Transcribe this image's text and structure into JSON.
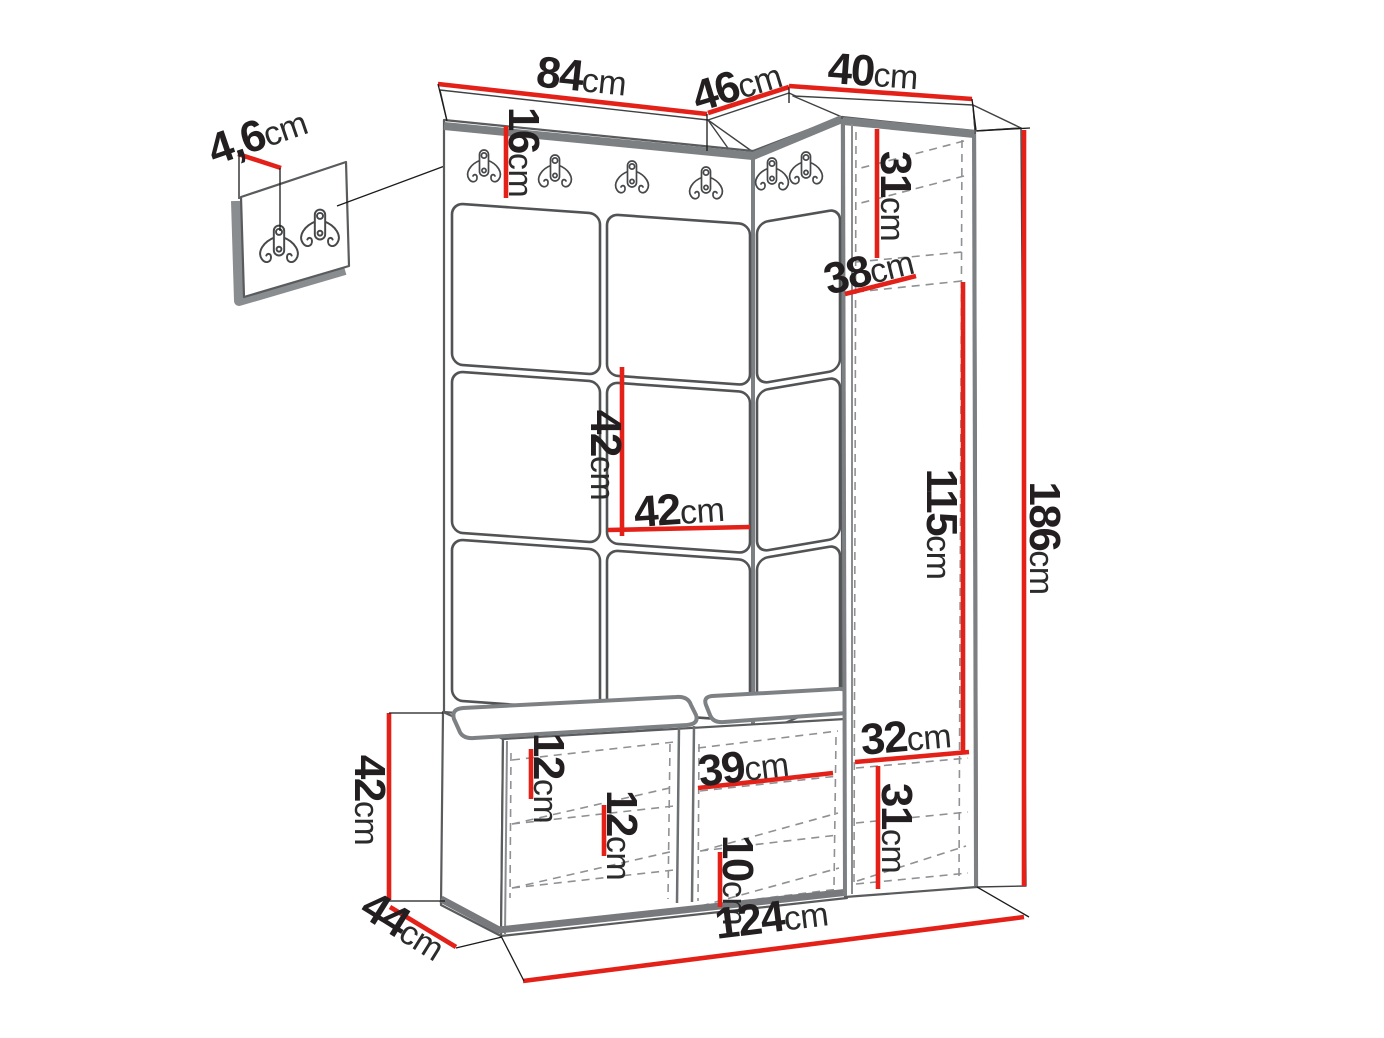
{
  "diagram": {
    "unit_default": "cm",
    "colors": {
      "dimension_red": "#e32119",
      "outline_gray": "#7d8083",
      "dashed_gray": "#8f9194",
      "label_text": "#231f20"
    },
    "icons": {
      "coat_hook": "double-coat-hook-icon"
    },
    "dims": {
      "panel_width": {
        "num": "84",
        "unit": "cm"
      },
      "corner_width": {
        "num": "46",
        "unit": "cm"
      },
      "cabinet_width": {
        "num": "40",
        "unit": "cm"
      },
      "small_panel_thickness": {
        "num": "4,6",
        "unit": "cm"
      },
      "hook_strip_height": {
        "num": "16",
        "unit": "cm"
      },
      "cabinet_top_height": {
        "num": "31",
        "unit": "cm"
      },
      "cabinet_depth": {
        "num": "38",
        "unit": "cm"
      },
      "tile_height": {
        "num": "42",
        "unit": "cm"
      },
      "tile_width": {
        "num": "42",
        "unit": "cm"
      },
      "cabinet_middle_height": {
        "num": "115",
        "unit": "cm"
      },
      "total_height": {
        "num": "186",
        "unit": "cm"
      },
      "cabinet_inner_width": {
        "num": "32",
        "unit": "cm"
      },
      "bench_height": {
        "num": "42",
        "unit": "cm"
      },
      "bench_depth": {
        "num": "44",
        "unit": "cm"
      },
      "bench_shelf_gap_a": {
        "num": "12",
        "unit": "cm"
      },
      "bench_shelf_gap_b": {
        "num": "12",
        "unit": "cm"
      },
      "shoe_shelf_width": {
        "num": "39",
        "unit": "cm"
      },
      "shoe_shelf_gap": {
        "num": "10",
        "unit": "cm"
      },
      "cabinet_bottom_height": {
        "num": "31",
        "unit": "cm"
      },
      "total_width": {
        "num": "124",
        "unit": "cm"
      }
    }
  }
}
